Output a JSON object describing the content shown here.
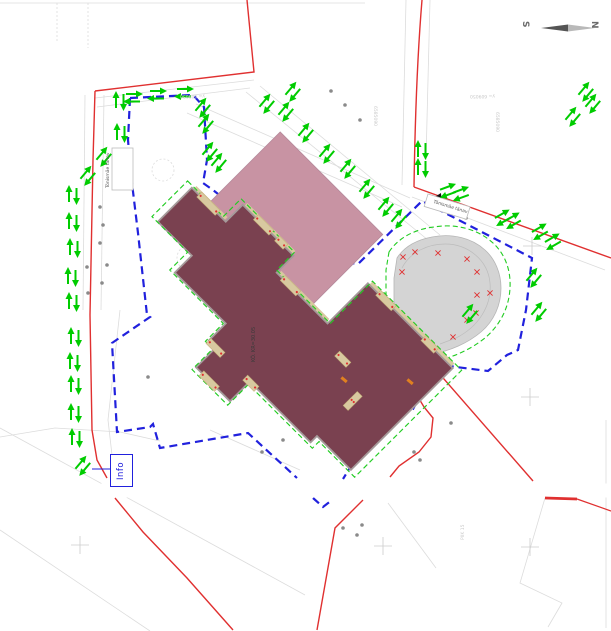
{
  "title": "Site plan drawing",
  "compass": {
    "north": "N",
    "south": "S"
  },
  "info_box": {
    "label": "Info"
  },
  "labels": {
    "street_left": "Tõnismäe tänav",
    "street_right": "Tõnismäe tänav",
    "building_elevation": "KÕ. KR=30.05",
    "grid_y_left": "y= 609050",
    "grid_y_right": "y= 609050",
    "grid_x_left": "6585090",
    "grid_x_right": "6585090",
    "benchmark": "PIIK 15"
  },
  "colors": {
    "site_boundary_blue": "#2121dd",
    "parcel_red": "#e03030",
    "traffic_arrow_green": "#00cc00",
    "main_building_fill": "#7a4150",
    "annex_building_fill": "#c893a3",
    "stadium_fill": "#d4d4d4",
    "entrance_tan": "#d8c9a0",
    "background": "#ffffff"
  },
  "markers": {
    "arrow_pairs": [
      [
        73,
        195,
        0
      ],
      [
        73,
        222,
        0
      ],
      [
        74,
        248,
        0
      ],
      [
        72,
        277,
        0
      ],
      [
        73,
        302,
        0
      ],
      [
        75,
        337,
        0
      ],
      [
        74,
        362,
        0
      ],
      [
        75,
        385,
        0
      ],
      [
        75,
        413,
        0
      ],
      [
        76,
        438,
        0
      ],
      [
        83,
        466,
        40
      ],
      [
        120,
        101,
        0
      ],
      [
        121,
        133,
        0
      ],
      [
        104,
        157,
        40
      ],
      [
        88,
        176,
        40
      ],
      [
        133,
        98,
        90
      ],
      [
        157,
        95,
        90
      ],
      [
        184,
        93,
        90
      ],
      [
        203,
        108,
        40
      ],
      [
        206,
        124,
        40
      ],
      [
        210,
        152,
        40
      ],
      [
        219,
        163,
        40
      ],
      [
        267,
        104,
        40
      ],
      [
        293,
        92,
        40
      ],
      [
        286,
        112,
        40
      ],
      [
        306,
        133,
        40
      ],
      [
        327,
        154,
        40
      ],
      [
        348,
        169,
        40
      ],
      [
        367,
        189,
        40
      ],
      [
        386,
        207,
        40
      ],
      [
        399,
        219,
        40
      ],
      [
        573,
        117,
        40
      ],
      [
        586,
        92,
        40
      ],
      [
        593,
        104,
        40
      ],
      [
        422,
        150,
        0
      ],
      [
        422,
        168,
        0
      ],
      [
        448,
        191,
        70
      ],
      [
        461,
        194,
        70
      ],
      [
        503,
        218,
        60
      ],
      [
        513,
        221,
        60
      ],
      [
        540,
        232,
        60
      ],
      [
        553,
        242,
        60
      ],
      [
        534,
        278,
        40
      ],
      [
        539,
        312,
        40
      ],
      [
        470,
        314,
        40
      ]
    ],
    "red_x": [
      [
        403,
        257
      ],
      [
        415,
        252
      ],
      [
        438,
        253
      ],
      [
        467,
        259
      ],
      [
        477,
        272
      ],
      [
        490,
        293
      ],
      [
        477,
        295
      ],
      [
        476,
        313
      ],
      [
        467,
        320
      ],
      [
        453,
        337
      ],
      [
        433,
        358
      ],
      [
        415,
        350
      ],
      [
        402,
        272
      ],
      [
        381,
        312
      ]
    ],
    "dots": [
      [
        100,
        207
      ],
      [
        103,
        225
      ],
      [
        100,
        243
      ],
      [
        107,
        265
      ],
      [
        87,
        267
      ],
      [
        102,
        283
      ],
      [
        88,
        293
      ],
      [
        240,
        227
      ],
      [
        300,
        318
      ],
      [
        345,
        105
      ],
      [
        331,
        91
      ],
      [
        360,
        120
      ],
      [
        451,
        423
      ],
      [
        414,
        452
      ],
      [
        420,
        460
      ],
      [
        148,
        377
      ],
      [
        283,
        440
      ],
      [
        262,
        452
      ],
      [
        447,
        210
      ],
      [
        466,
        218
      ],
      [
        343,
        528
      ],
      [
        362,
        525
      ],
      [
        357,
        535
      ]
    ],
    "grid_crosses": [
      [
        532,
        246
      ],
      [
        530,
        397
      ],
      [
        530,
        547
      ],
      [
        383,
        546
      ],
      [
        80,
        545
      ]
    ],
    "entrances": [
      [
        140,
        299,
        26,
        7
      ],
      [
        196,
        275,
        22,
        7
      ],
      [
        226,
        275,
        12,
        7
      ],
      [
        258,
        299,
        22,
        7
      ],
      [
        336,
        242,
        22,
        7
      ],
      [
        400,
        242,
        18,
        7
      ],
      [
        250,
        396,
        20,
        7
      ],
      [
        302,
        396,
        16,
        7
      ],
      [
        268,
        424,
        22,
        7
      ],
      [
        391,
        330,
        7,
        20
      ],
      [
        350,
        314,
        16,
        7
      ]
    ]
  }
}
